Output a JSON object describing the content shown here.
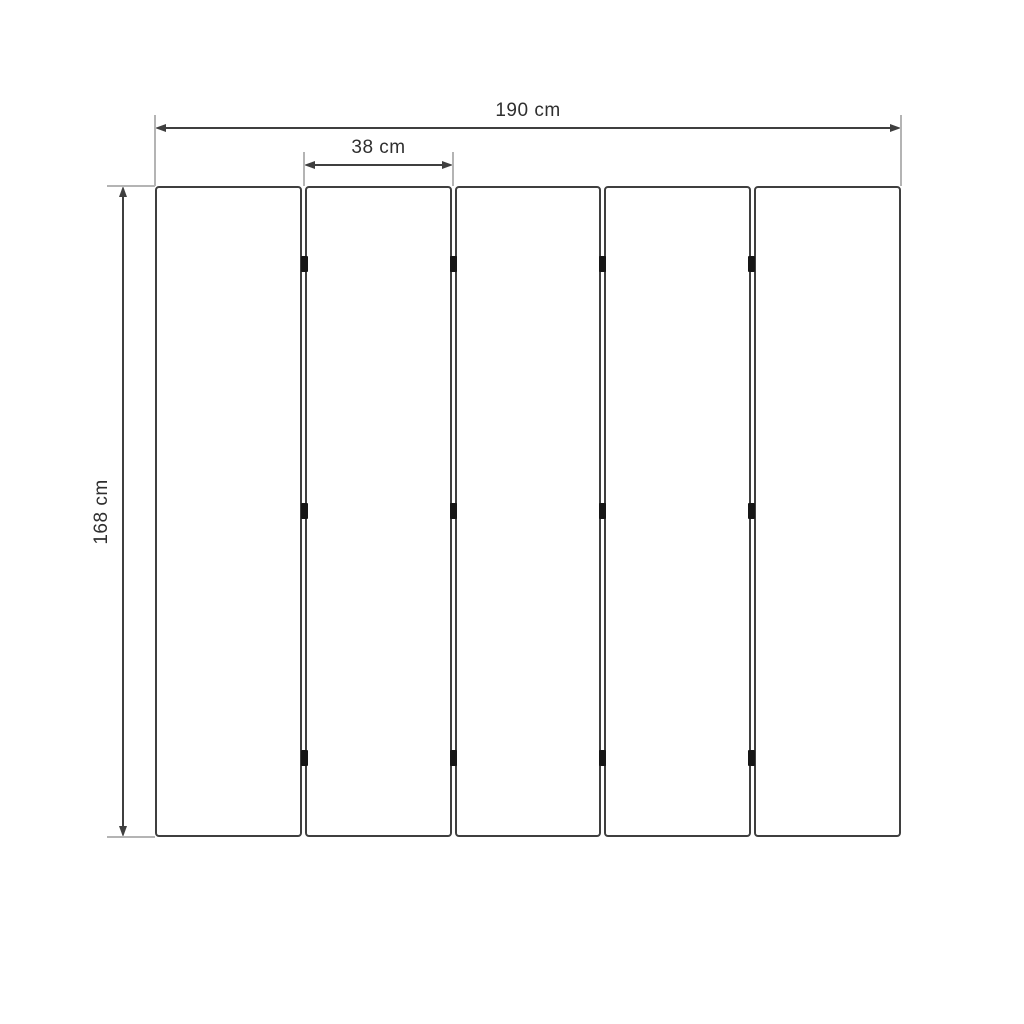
{
  "diagram": {
    "labels": {
      "total_width": "190 cm",
      "panel_width": "38 cm",
      "height": "168 cm"
    },
    "panel_count": 5,
    "joint_count": 4,
    "hinges_per_joint": 3,
    "colors": {
      "background": "#ffffff",
      "dimension_line": "#3f3f3f",
      "extension_line": "#b4b4b4",
      "panel_border": "#3f3f3f",
      "panel_fill": "#ffffff",
      "hinge": "#161616",
      "text": "#2f2f2f"
    }
  }
}
